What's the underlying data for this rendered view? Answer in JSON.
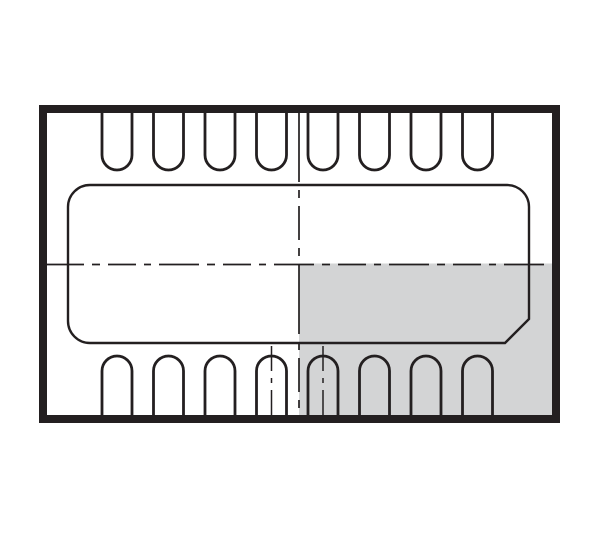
{
  "diagram": {
    "type": "dfn-package-top-view-outline",
    "canvas": {
      "width": 600,
      "height": 533,
      "background": "#ffffff"
    },
    "colors": {
      "line": "#231f20",
      "shade": "#d3d4d5",
      "background": "#ffffff"
    },
    "package_outline": {
      "outer_left": 39,
      "outer_top": 105,
      "outer_right": 560,
      "outer_bottom": 423,
      "stroke_width": 8
    },
    "shaded_quadrant": {
      "position": "bottom-right",
      "left": 299,
      "top": 263.5,
      "right": 552,
      "bottom": 416
    },
    "exposed_pad": {
      "left": 68,
      "top": 185,
      "right": 529,
      "bottom": 343,
      "corner_radius": 22,
      "chamfer_size": 24,
      "chamfer_corner": "bottom-right",
      "stroke_width": 2.4
    },
    "pins": {
      "count_top": 8,
      "count_bottom": 8,
      "first_center_x": 117,
      "pitch": 51.5,
      "width": 30,
      "tip_radius": 15,
      "stroke_width": 2.8,
      "top_attach_y": 108,
      "top_tip_y": 170,
      "bottom_attach_y": 420,
      "bottom_tip_y": 356
    },
    "centerlines": {
      "stroke_width": 1.7,
      "vertical": {
        "x": 299,
        "y1": 112,
        "y2": 415,
        "dash": "70 8 8 8 34 8 8 8"
      },
      "horizontal": {
        "y": 264.5,
        "x1": 44,
        "x2": 552,
        "dash": "40 8 8 8 28 8 7 8"
      },
      "bottom_pin_marks": [
        {
          "pin_index": 4,
          "x": 271.5,
          "y1": 346,
          "y2": 415,
          "dash": "25 7 5 7"
        },
        {
          "pin_index": 5,
          "x": 323,
          "y1": 346,
          "y2": 415,
          "dash": "25 7 5 7"
        }
      ]
    }
  }
}
